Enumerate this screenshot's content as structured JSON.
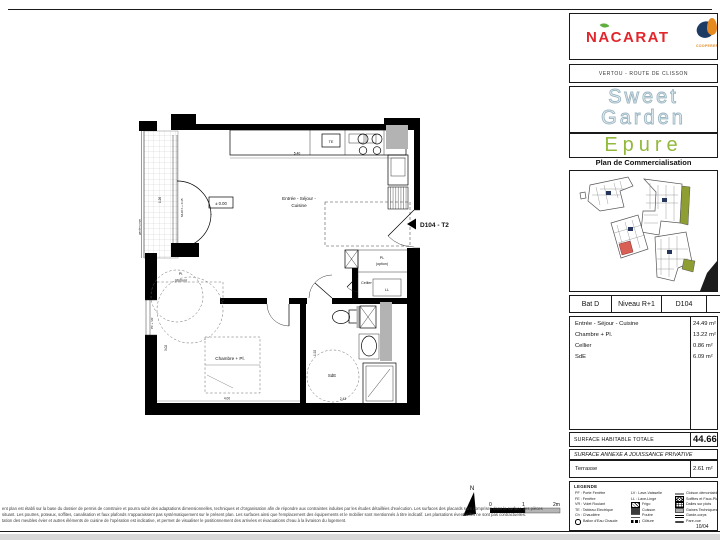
{
  "colors": {
    "brand_red": "#e2262c",
    "leaf_green": "#5fae3f",
    "project_green": "#93b93c",
    "outline_blue": "#9cb6c2",
    "site_green": "#8f9e33",
    "highlight_red": "#d95f55",
    "wall_black": "#000000",
    "gaine_gray": "#b3b3b3"
  },
  "header": {
    "developer": "NACARAT",
    "coop_text": "COOPERER",
    "location": "VERTOU - ROUTE DE CLISSON",
    "project_line1": "Sweet",
    "project_line2": "Garden",
    "project_sub": "Epure",
    "plan_title": "Plan de Commercialisation"
  },
  "unit": {
    "building": "Bat D",
    "level": "Niveau R+1",
    "number": "D104",
    "type": "T2",
    "arrow_label": "D104 - T2"
  },
  "rooms": [
    {
      "name": "Entrée - Séjour - Cuisine",
      "area": "24.49 m²"
    },
    {
      "name": "Chambre + Pl.",
      "area": "13.22 m²"
    },
    {
      "name": "Cellier",
      "area": "0.86 m²"
    },
    {
      "name": "SdE",
      "area": "6.09 m²"
    }
  ],
  "totals": {
    "habitable_label": "SURFACE HABITABLE TOTALE",
    "habitable_value": "44.66 m²",
    "annex_label": "SURFACE ANNEXE A JOUISSANCE PRIVATIVE"
  },
  "annex": {
    "name": "Terrasse",
    "area": "2.61 m²"
  },
  "legend": {
    "title": "LEGENDE",
    "col1": [
      "PF : Porte Fenêtre",
      "FE : Fenêtre",
      "VR : Volet Roulant",
      "TE : Tableau Electrique",
      "Ch : Chaudière",
      "Ballon d'Eau Chaude"
    ],
    "col2": [
      "LV : Lave-Vaisselle",
      "LL : Lave-Linge",
      "Frigo",
      "Cuisson",
      "Poutre",
      "Clôture"
    ],
    "col3": [
      "Cloison démontable",
      "Soffites et Faux-Plafonds",
      "Dalles sur plots",
      "Gaines Techniques",
      "Garde-corps",
      "Pare-vue"
    ],
    "date": "10/04"
  },
  "plan": {
    "room_main_1": "Entrée - Séjour -",
    "room_main_2": "Cuisine",
    "room_chambre": "Chambre + Pl.",
    "room_sde": "SdE",
    "room_cellier": "Cellier",
    "room_pl_1": "Pl.",
    "room_pl_2": "(option)",
    "room_pl2_1": "PL",
    "room_pl2_2": "(option)",
    "label_te": "TE",
    "label_ll": "LL",
    "label_level": "± 0.00",
    "label_mur": "MUR h + 0.35",
    "label_pfvr": "PF + VR",
    "label_garde": "garde-corps",
    "dim_top": "5.40",
    "dim_terrace": "1.26",
    "dim_chambre_w": "4.00",
    "dim_chambre_h": "3.02",
    "dim_sde_w": "2.43",
    "dim_sde_h": "1.92"
  },
  "scale": {
    "north": "N",
    "t0": "0",
    "t1": "1",
    "t2": "2m"
  },
  "disclaimer": {
    "line1": "ent plan est établi sur la base du dossier de permis de construire et pourra subir des adaptations dimensionnelles, techniques et d'organisation afin de répondre aux contraintes induites par les études détaillées d'exécution. Les surfaces des placards sont comprises dans la surface des pièces",
    "line2": "situant. Les poutres, poteaux, soffites, canalisation et faux plafonds n'apparaissent pas systématiquement sur le présent plan. Les surfaces ainsi que l'emplacement des équipements et le mobilier sont mentionnés à titre indicatif. Les plantations éventuelles ne sont pas contractuelles.",
    "line3": "tation des meubles évier et autres éléments de cuisine de l'opération est indicative, et permet de visualiser le positionnement des arrivées et évacuations d'eau à la livraison du logement."
  }
}
